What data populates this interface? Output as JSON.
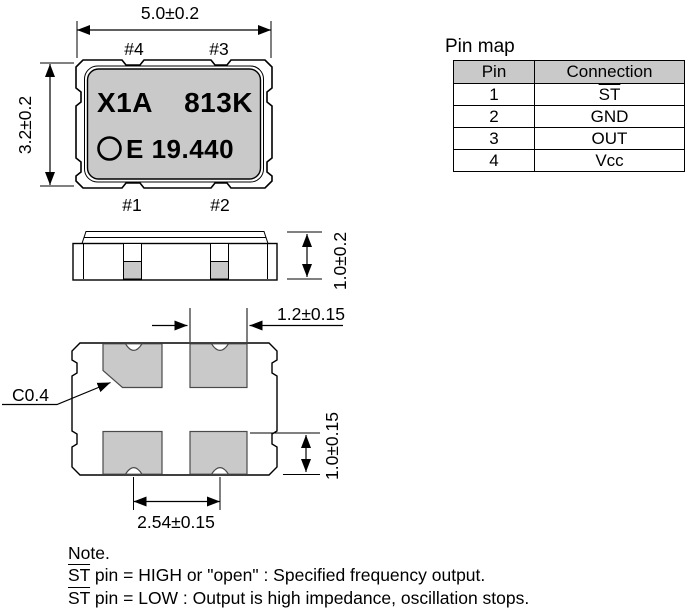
{
  "colors": {
    "fill_gray": "#c9c9c9",
    "ink": "#000000"
  },
  "top_view": {
    "dim_width": "5.0±0.2",
    "dim_height": "3.2±0.2",
    "pad_top_left": "#4",
    "pad_top_right": "#3",
    "pad_bottom_left": "#1",
    "pad_bottom_right": "#2",
    "marking_line1_left": "X1A",
    "marking_line1_right": "813K",
    "marking_line2": "E 19.440"
  },
  "side_view": {
    "dim_height": "1.0±0.2"
  },
  "bottom_view": {
    "dim_pad_width": "1.2±0.15",
    "dim_pad_height": "1.0±0.15",
    "dim_pad_pitch": "2.54±0.15",
    "chamfer": "C0.4"
  },
  "pin_map": {
    "title": "Pin map",
    "col_pin": "Pin",
    "col_connection": "Connection",
    "rows": [
      {
        "pin": "1",
        "connection": "ST"
      },
      {
        "pin": "2",
        "connection": "GND"
      },
      {
        "pin": "3",
        "connection": "OUT"
      },
      {
        "pin": "4",
        "connection": "Vcc"
      }
    ]
  },
  "note": {
    "title": "Note.",
    "line1": {
      "st": "ST",
      "rest": " pin = HIGH or \"open\" : Specified frequency output."
    },
    "line2": {
      "st": "ST",
      "rest": " pin = LOW : Output is high impedance, oscillation stops."
    }
  }
}
